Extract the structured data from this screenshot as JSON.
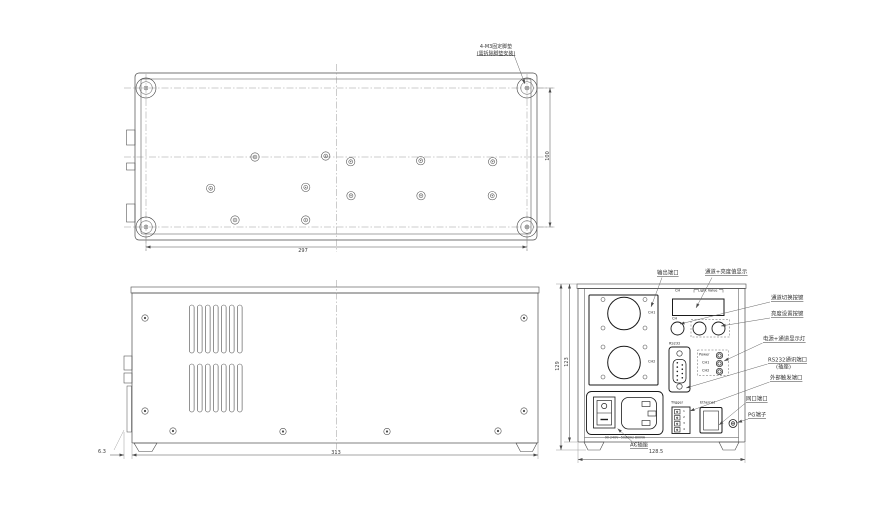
{
  "colors": {
    "background": "#ffffff",
    "line": "#4a4a4a",
    "bold_line": "#1a1a1a",
    "thin_line": "#777777"
  },
  "views": {
    "bottom": {
      "note_line1": "4-M3固定脚垫",
      "note_line2": "(需拆除脚垫安装)",
      "dim_width": "297",
      "dim_depth": "100"
    },
    "side": {
      "dim_length": "313",
      "dim_foot_offset": "6.3"
    },
    "back": {
      "dim_width": "128.5",
      "dim_height_outer": "129",
      "dim_height_inner": "123",
      "panel": {
        "output_ch1": "CH1",
        "output_ch2": "CH2",
        "display_ch": "CH",
        "display_value": "Light Value",
        "button_ch": "CH",
        "rs232": "RS232",
        "led_power": "Power",
        "led_ch1": "CH1",
        "led_ch2": "CH2",
        "trigger": "Trigger",
        "trigger_pins": [
          "1",
          "2",
          "3",
          "4"
        ],
        "ethernet": "Ethernet",
        "ac_rating": "90-240V~50/60Hz 800VA"
      },
      "callouts": {
        "output_port": "输出端口",
        "display": "通道+亮度值显示",
        "channel_switch": "通道切换按键",
        "brightness_set": "亮度设置按键",
        "indicators": "电源+通道显示灯",
        "rs232_line1": "RS232通讯端口",
        "rs232_line2": "(插座)",
        "trigger_port": "外部触发端口",
        "lan_port": "网口端口",
        "pg_terminal": "PG端子",
        "ac_socket": "AC插座"
      }
    }
  }
}
